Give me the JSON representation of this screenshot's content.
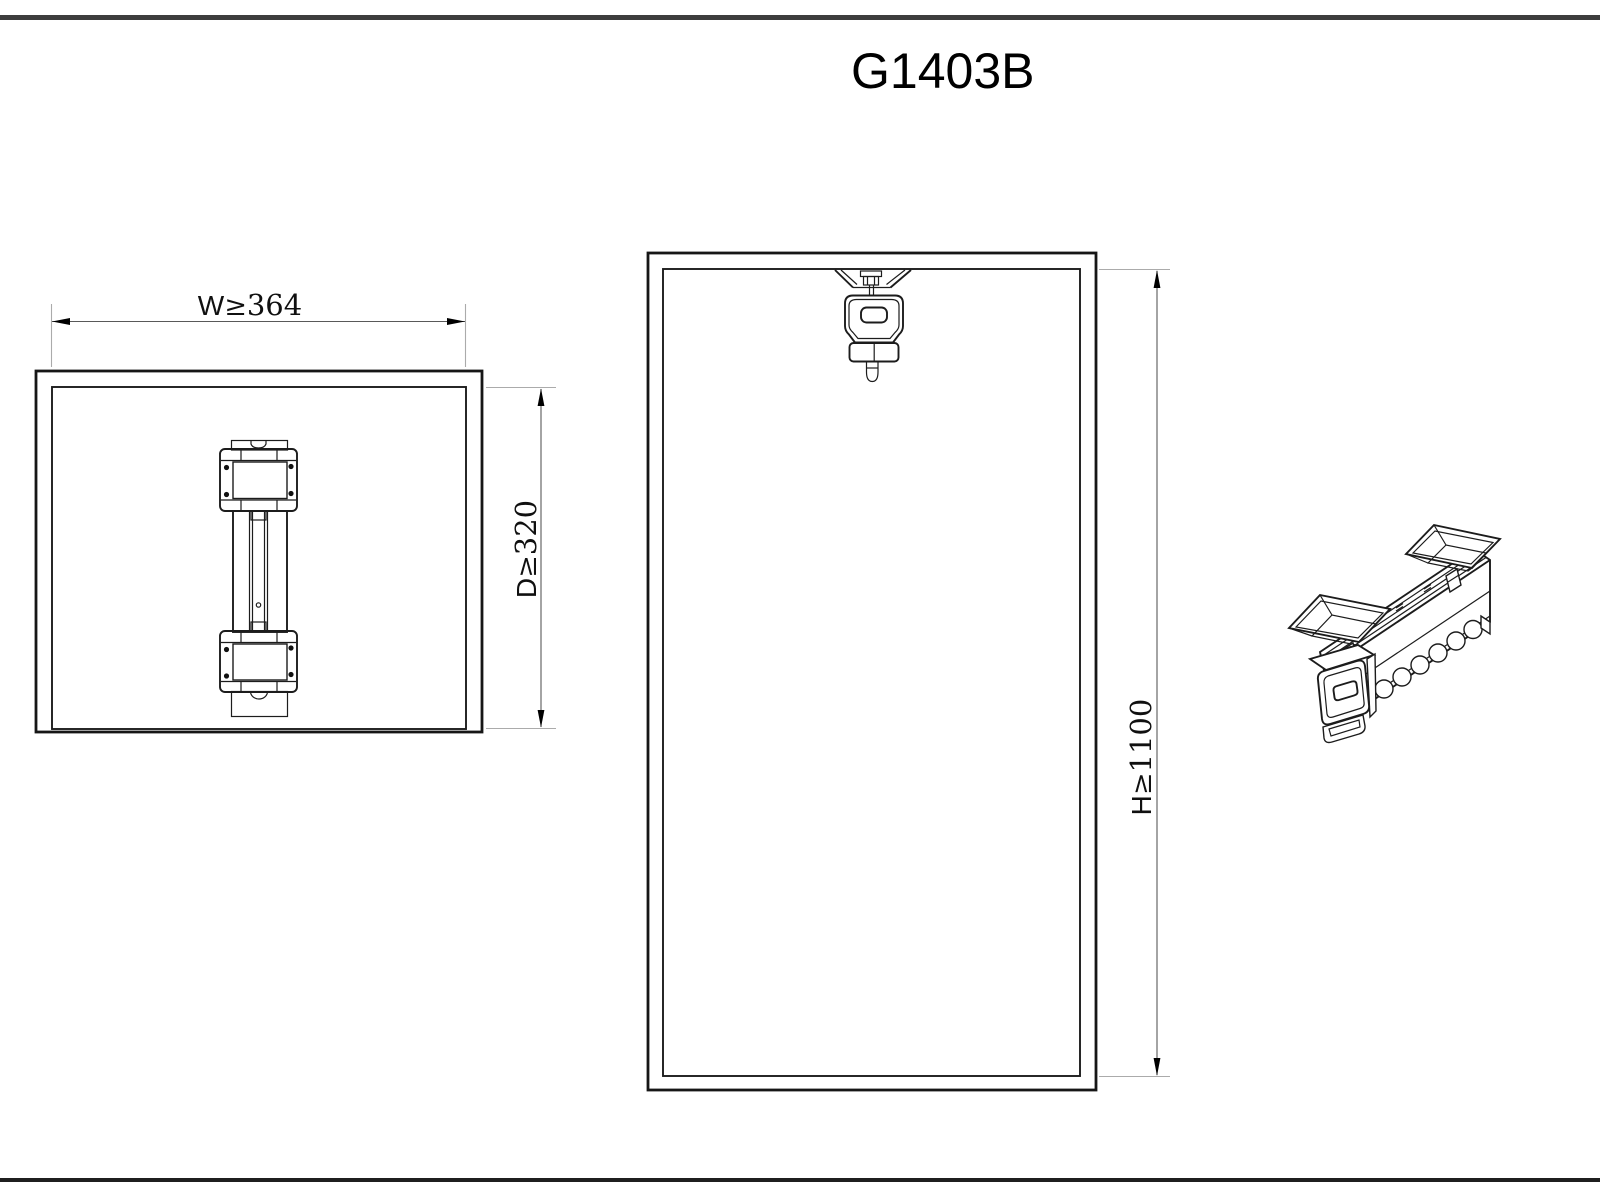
{
  "title": "G1403B",
  "dimensions": {
    "width": {
      "letter": "W",
      "symbol": "≥",
      "value": "364"
    },
    "depth": {
      "letter": "D",
      "symbol": "≥",
      "value": "320"
    },
    "height": {
      "letter": "H",
      "symbol": "≥",
      "value": "1100"
    }
  },
  "colors": {
    "line": "#1c1c1c",
    "dimension_line": "#595959",
    "extension_line": "#ababab",
    "arrow": "#000000",
    "sheet_bar": "#3d3d3d",
    "background": "#ffffff"
  }
}
